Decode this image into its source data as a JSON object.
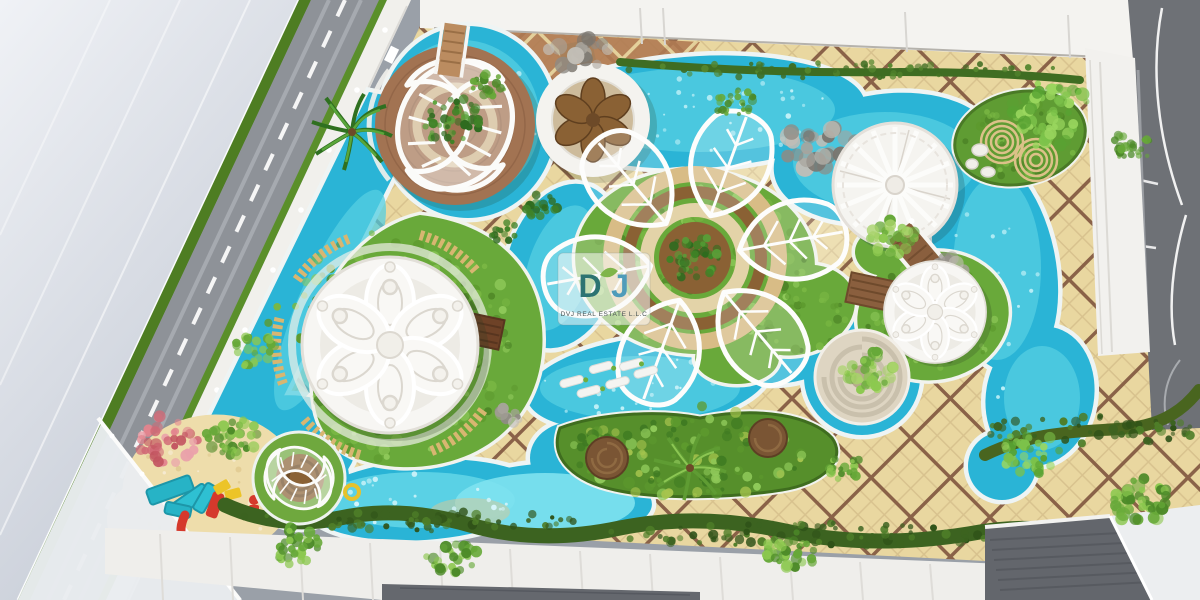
{
  "meta": {
    "type": "3D aerial architectural rendering, top-down view",
    "subject": "Rooftop resort amenity deck with lazy-river pool, lawns, ornamental white lattice pavilions, kids playground and tiled promenade"
  },
  "watermark": {
    "logo_d": "D",
    "logo_j": "J",
    "company": "DVJ REAL ESTATE L.L.C",
    "logo_teal": "#2d7472",
    "logo_blue": "#4f9cba",
    "leaf_green": "#7fb54a"
  },
  "palette": {
    "pool_water": "#2ab4d6",
    "pool_shallow": "#7ee2ef",
    "lawn_green": "#69a93a",
    "tile_beige": "#e9d7a0",
    "tile_joint_brown": "#8a6248",
    "terracotta_tile": "#b07a52",
    "structure_white": "#f6f5f2",
    "timber_brown": "#9a6b4a",
    "hedge_dark_green": "#3c6320",
    "sand_beige": "#eeddab",
    "asphalt_gray": "#6e7176",
    "building_gray": "#dfe3e9",
    "play_cyan": "#27b3c6",
    "play_red": "#d5392c",
    "play_yellow": "#ecc428"
  },
  "scene": {
    "elements": [
      {
        "name": "leaf-lattice-deck-pavilion",
        "location": "top-left"
      },
      {
        "name": "flower-medallion-pool-deck",
        "location": "top-center"
      },
      {
        "name": "lotus-lattice-centerpiece",
        "location": "center"
      },
      {
        "name": "rose-window-dome-pavilion",
        "location": "center-left"
      },
      {
        "name": "pinwheel-gazebo",
        "location": "right"
      },
      {
        "name": "small-rose-dome-pavilion",
        "location": "center-right"
      },
      {
        "name": "spiral-fountain-island",
        "location": "center-right"
      },
      {
        "name": "leaf-spiral-play-pavilion",
        "location": "bottom-left"
      },
      {
        "name": "children-playground",
        "location": "bottom-left"
      },
      {
        "name": "lazy-river-pool",
        "location": "throughout"
      },
      {
        "name": "kids-splash-pool",
        "location": "bottom-center"
      },
      {
        "name": "planted-island-beds",
        "location": "bottom-center and top-right"
      },
      {
        "name": "timber-bridges",
        "location": "pool crossings"
      },
      {
        "name": "perimeter-road",
        "location": "left and top-right"
      },
      {
        "name": "rooftop-buildings",
        "location": "edges"
      }
    ]
  }
}
